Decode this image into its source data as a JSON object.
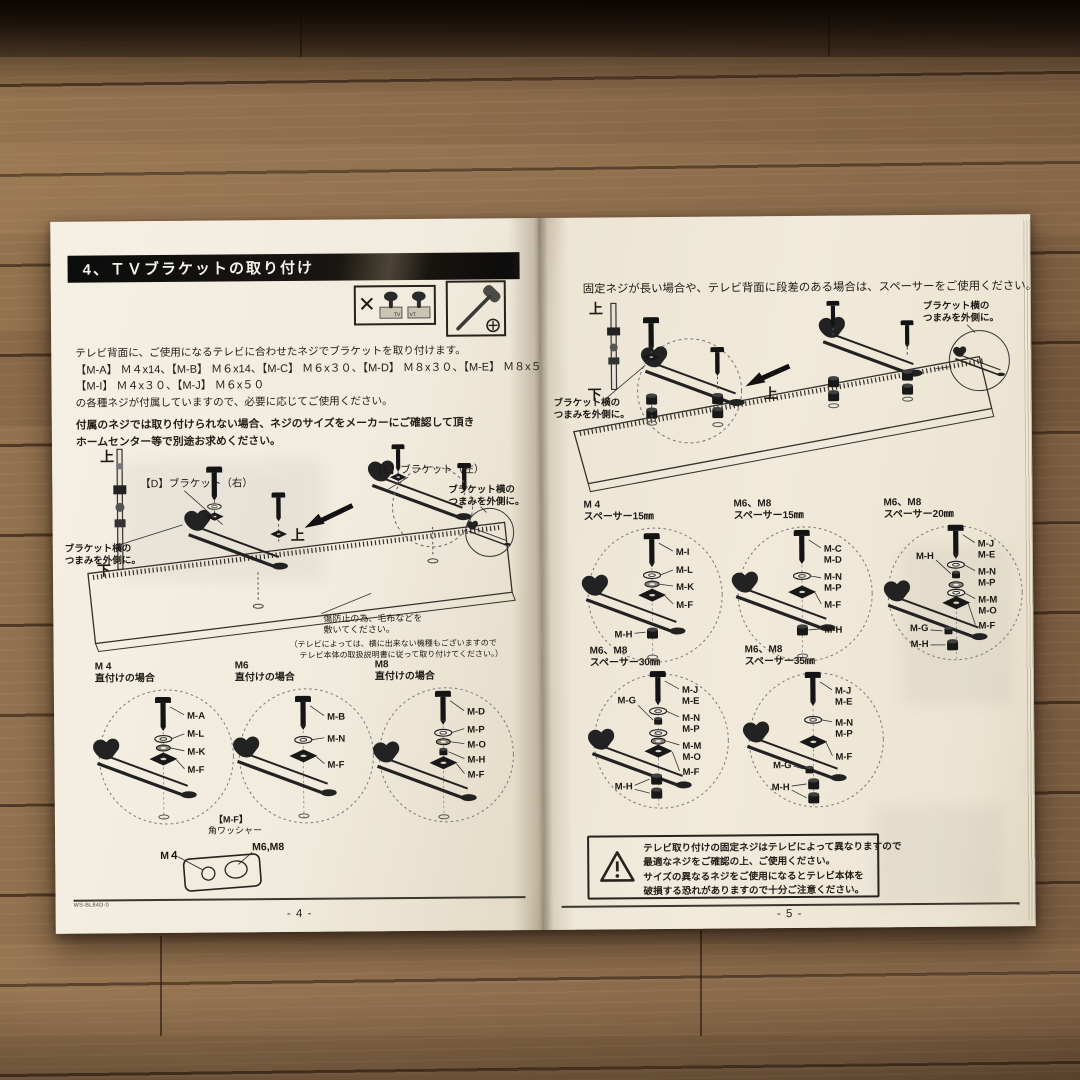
{
  "left_page": {
    "header": "4、ＴＶブラケットの取り付け",
    "icons": {
      "x_mark": "✕",
      "tv1": "TV",
      "tv2": "TV"
    },
    "intro": "テレビ背面に、ご使用になるテレビに合わせたネジでブラケットを取り付けます。",
    "screws1": "【M-A】 Ｍ４x14、【M-B】 Ｍ６x14、【M-C】 Ｍ６x３０、【M-D】 Ｍ８x３０、【M-E】 Ｍ８x５０",
    "screws2": "【M-I】 Ｍ４x３０、【M-J】 Ｍ６x５０",
    "note": "の各種ネジが付属していますので、必要に応じてご使用ください。",
    "warn1": "付属のネジでは取り付けられない場合、ネジのサイズをメーカーにご確認して頂き",
    "warn2": "ホームセンター等で別途お求めください。",
    "diagram": {
      "up": "上",
      "down": "下",
      "up_arrow": "上",
      "bracket_d": "【D】ブラケット（右）",
      "bracket_e": "【E】ブラケット（左）",
      "knob1": "ブラケット横の",
      "knob2": "つまみを外側に。",
      "protect1": "傷防止の為、毛布などを",
      "protect2": "敷いてください。",
      "tvnote1": "（テレビによっては、横に出来ない機種もございますので",
      "tvnote2": "テレビ本体の取扱説明書に従って取り付けてください。）"
    },
    "circles": [
      {
        "size": "M 4",
        "caption": "直付けの場合",
        "parts": [
          "M-A",
          "M-L",
          "M-K",
          "M-F"
        ]
      },
      {
        "size": "M6",
        "caption": "直付けの場合",
        "parts": [
          "M-B",
          "M-N",
          "M-F"
        ]
      },
      {
        "size": "M8",
        "caption": "直付けの場合",
        "parts": [
          "M-D",
          "M-P",
          "M-O",
          "M-H",
          "M-F"
        ]
      }
    ],
    "washer": {
      "name1": "【M-F】",
      "name2": "角ワッシャー",
      "m4": "M４",
      "m68": "M6,M8"
    },
    "footer_code": "WS-BL84D-0",
    "page_num": "- 4 -"
  },
  "right_page": {
    "intro": "固定ネジが長い場合や、テレビ背面に段差のある場合は、スペーサーをご使用ください。",
    "diagram": {
      "up": "上",
      "down": "下",
      "up_arrow": "上",
      "knob1": "ブラケット横の",
      "knob2": "つまみを外側に。"
    },
    "circles": [
      {
        "size": "M 4",
        "caption": "スペーサー15㎜",
        "right": [
          "M-I",
          "M-L",
          "M-K",
          "M-F"
        ],
        "left": [
          "M-H"
        ]
      },
      {
        "size": "M6、M8",
        "caption": "スペーサー15㎜",
        "right": [
          "M-C",
          "M-D",
          "M-N",
          "M-P",
          "M-F",
          "M-H"
        ],
        "left": []
      },
      {
        "size": "M6、M8",
        "caption": "スペーサー20㎜",
        "right": [
          "M-J",
          "M-E",
          "M-N",
          "M-P",
          "M-M",
          "M-O",
          "M-F"
        ],
        "left": [
          "M-H",
          "M-G",
          "M-H"
        ]
      },
      {
        "size": "M6、M8",
        "caption": "スペーサー30㎜",
        "right": [
          "M-J",
          "M-E",
          "M-N",
          "M-P",
          "M-M",
          "M-O",
          "M-F"
        ],
        "left": [
          "M-G",
          "M-H"
        ]
      },
      {
        "size": "M6、M8",
        "caption": "スペーサー35㎜",
        "right": [
          "M-J",
          "M-E",
          "M-N",
          "M-P",
          "M-F"
        ],
        "left": [
          "M-G",
          "M-H"
        ]
      }
    ],
    "warning": {
      "line1": "テレビ取り付けの固定ネジはテレビによって異なりますので",
      "line2": "最適なネジをご確認の上、ご使用ください。",
      "line3": "サイズの異なるネジをご使用になるとテレビ本体を",
      "line4": "破損する恐れがありますので十分ご注意ください。"
    },
    "page_num": "- 5 -"
  }
}
